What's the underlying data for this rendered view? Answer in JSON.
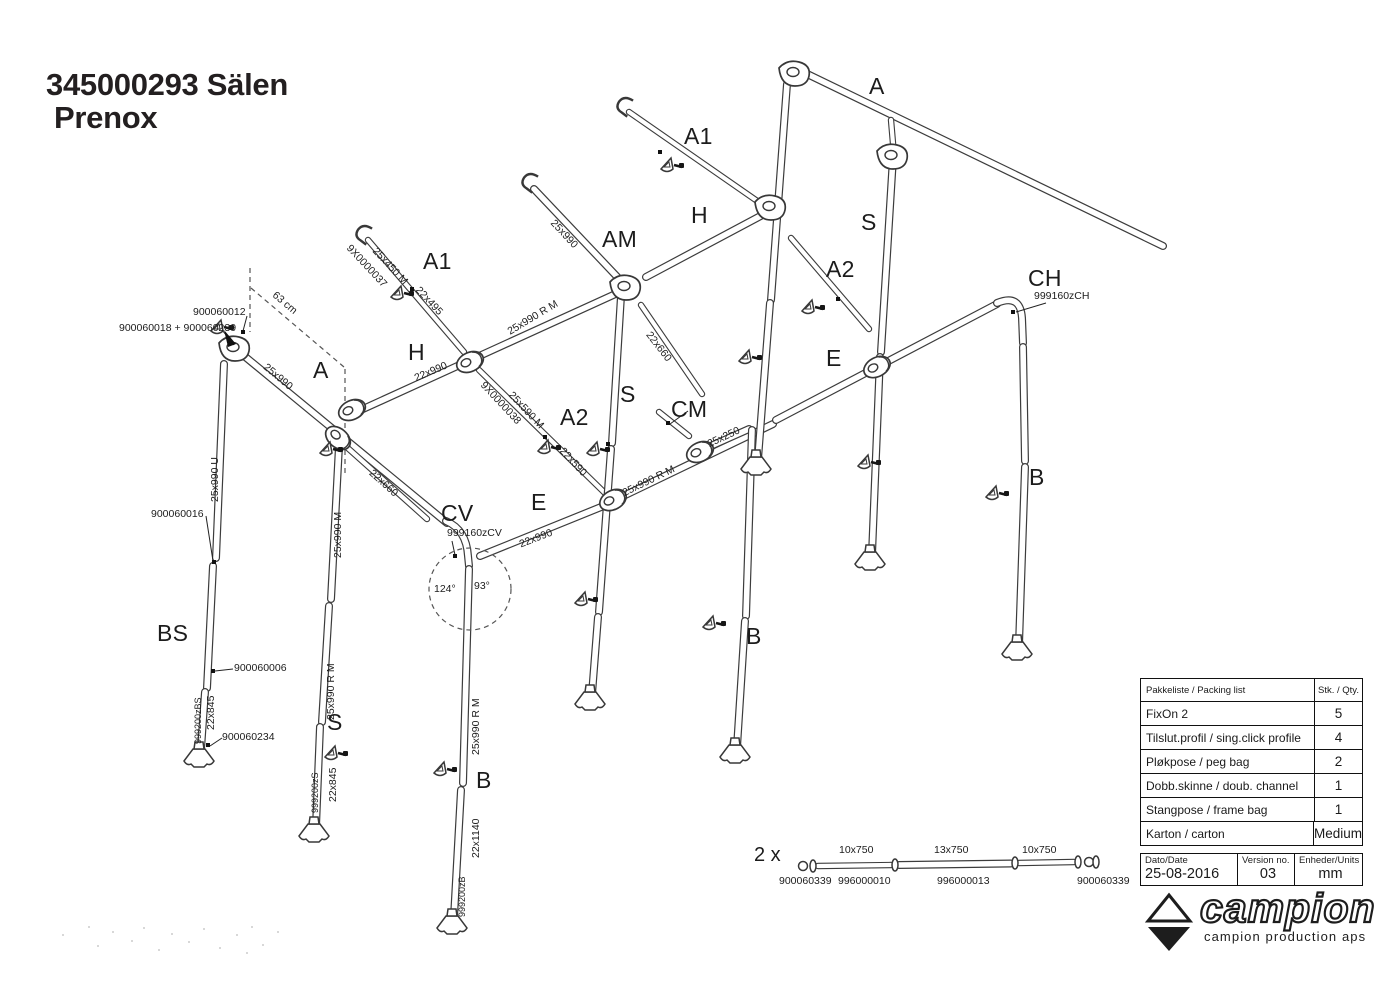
{
  "title": {
    "line1": "345000293 Sälen",
    "line2": "Prenox"
  },
  "diagram": {
    "labels": [
      {
        "t": "A",
        "x": 869,
        "y": 75,
        "s": "xl"
      },
      {
        "t": "A1",
        "x": 684,
        "y": 125,
        "s": "xl"
      },
      {
        "t": "H",
        "x": 691,
        "y": 204,
        "s": "xl"
      },
      {
        "t": "S",
        "x": 861,
        "y": 211,
        "s": "xl"
      },
      {
        "t": "A2",
        "x": 826,
        "y": 258,
        "s": "xl"
      },
      {
        "t": "AM",
        "x": 602,
        "y": 228,
        "s": "xl"
      },
      {
        "t": "CH",
        "x": 1028,
        "y": 267,
        "s": "xl"
      },
      {
        "t": "E",
        "x": 826,
        "y": 347,
        "s": "xl"
      },
      {
        "t": "CM",
        "x": 671,
        "y": 398,
        "s": "xl"
      },
      {
        "t": "S",
        "x": 620,
        "y": 383,
        "s": "xl"
      },
      {
        "t": "A2",
        "x": 560,
        "y": 406,
        "s": "xl"
      },
      {
        "t": "A1",
        "x": 423,
        "y": 250,
        "s": "xl"
      },
      {
        "t": "H",
        "x": 408,
        "y": 341,
        "s": "xl"
      },
      {
        "t": "A",
        "x": 313,
        "y": 359,
        "s": "xl"
      },
      {
        "t": "E",
        "x": 531,
        "y": 491,
        "s": "xl"
      },
      {
        "t": "CV",
        "x": 441,
        "y": 502,
        "s": "xl"
      },
      {
        "t": "B",
        "x": 1029,
        "y": 466,
        "s": "xl"
      },
      {
        "t": "B",
        "x": 746,
        "y": 625,
        "s": "xl"
      },
      {
        "t": "B",
        "x": 476,
        "y": 769,
        "s": "xl"
      },
      {
        "t": "S",
        "x": 327,
        "y": 711,
        "s": "xl"
      },
      {
        "t": "BS",
        "x": 157,
        "y": 622,
        "s": "xl"
      },
      {
        "t": "2 x",
        "x": 754,
        "y": 845,
        "s": "lg"
      },
      {
        "t": "900060012",
        "x": 193,
        "y": 307,
        "s": "sm"
      },
      {
        "t": "900060018 + 900060239",
        "x": 119,
        "y": 323,
        "s": "sm"
      },
      {
        "t": "900060016",
        "x": 151,
        "y": 509,
        "s": "sm"
      },
      {
        "t": "900060006",
        "x": 234,
        "y": 663,
        "s": "sm"
      },
      {
        "t": "900060234",
        "x": 222,
        "y": 732,
        "s": "sm"
      },
      {
        "t": "999160zCH",
        "x": 1034,
        "y": 291,
        "s": "sm"
      },
      {
        "t": "999160zCV",
        "x": 447,
        "y": 528,
        "s": "sm"
      },
      {
        "t": "124°",
        "x": 434,
        "y": 584,
        "s": "sm"
      },
      {
        "t": "93°",
        "x": 474,
        "y": 581,
        "s": "sm"
      },
      {
        "t": "10x750",
        "x": 839,
        "y": 845,
        "s": "sm"
      },
      {
        "t": "13x750",
        "x": 934,
        "y": 845,
        "s": "sm"
      },
      {
        "t": "10x750",
        "x": 1022,
        "y": 845,
        "s": "sm"
      },
      {
        "t": "900060339",
        "x": 779,
        "y": 876,
        "s": "sm"
      },
      {
        "t": "996000010",
        "x": 838,
        "y": 876,
        "s": "sm"
      },
      {
        "t": "996000013",
        "x": 937,
        "y": 876,
        "s": "sm"
      },
      {
        "t": "900060339",
        "x": 1077,
        "y": 876,
        "s": "sm"
      },
      {
        "t": "63 cm",
        "x": 277,
        "y": 290,
        "r": 40,
        "s": "sm"
      },
      {
        "t": "25x990",
        "x": 268,
        "y": 362,
        "r": 40,
        "s": "sm"
      },
      {
        "t": "22x660",
        "x": 374,
        "y": 468,
        "r": 42,
        "s": "sm"
      },
      {
        "t": "9X0000037",
        "x": 352,
        "y": 243,
        "r": 47,
        "s": "sm"
      },
      {
        "t": "25x450 M",
        "x": 378,
        "y": 246,
        "r": 47,
        "s": "sm"
      },
      {
        "t": "22x495",
        "x": 421,
        "y": 285,
        "r": 47,
        "s": "sm"
      },
      {
        "t": "9X0000038",
        "x": 486,
        "y": 380,
        "r": 47,
        "s": "sm"
      },
      {
        "t": "25x590 M",
        "x": 514,
        "y": 390,
        "r": 47,
        "s": "sm"
      },
      {
        "t": "22x590",
        "x": 565,
        "y": 446,
        "r": 47,
        "s": "sm"
      },
      {
        "t": "25x990",
        "x": 556,
        "y": 218,
        "r": 47,
        "s": "sm"
      },
      {
        "t": "22x660",
        "x": 652,
        "y": 330,
        "r": 52,
        "s": "sm"
      },
      {
        "t": "22x990",
        "x": 413,
        "y": 374,
        "r": -23,
        "s": "sm"
      },
      {
        "t": "25x990 R M",
        "x": 506,
        "y": 328,
        "r": -31,
        "s": "sm"
      },
      {
        "t": "25x250",
        "x": 706,
        "y": 440,
        "r": -25,
        "s": "sm"
      },
      {
        "t": "25x990 R M",
        "x": 621,
        "y": 489,
        "r": -26,
        "s": "sm"
      },
      {
        "t": "22x990",
        "x": 518,
        "y": 540,
        "r": -21,
        "s": "sm"
      },
      {
        "t": "25x990 U",
        "x": 210,
        "y": 502,
        "r": -90,
        "s": "sm"
      },
      {
        "t": "25x990 M",
        "x": 333,
        "y": 558,
        "r": -90,
        "s": "sm"
      },
      {
        "t": "25x990 R M",
        "x": 326,
        "y": 720,
        "r": -90,
        "s": "sm"
      },
      {
        "t": "22x845",
        "x": 206,
        "y": 730,
        "r": -90,
        "s": "sm"
      },
      {
        "t": "999200zBS",
        "x": 194,
        "y": 744,
        "r": -90,
        "s": "xs"
      },
      {
        "t": "22x845",
        "x": 328,
        "y": 802,
        "r": -90,
        "s": "sm"
      },
      {
        "t": "999200zS",
        "x": 311,
        "y": 813,
        "r": -90,
        "s": "xs"
      },
      {
        "t": "25x990 R M",
        "x": 471,
        "y": 755,
        "r": -90,
        "s": "sm"
      },
      {
        "t": "22x1140",
        "x": 471,
        "y": 858,
        "r": -90,
        "s": "sm"
      },
      {
        "t": "999200zB",
        "x": 458,
        "y": 917,
        "r": -90,
        "s": "xs"
      }
    ]
  },
  "packing_table": {
    "header": {
      "col1": "Pakkeliste / Packing list",
      "col2": "Stk. / Qty."
    },
    "rows": [
      {
        "item": "FixOn 2",
        "qty": "5"
      },
      {
        "item": "Tilslut.profil / sing.click profile",
        "qty": "4"
      },
      {
        "item": "Pløkpose / peg bag",
        "qty": "2"
      },
      {
        "item": "Dobb.skinne / doub. channel",
        "qty": "1"
      },
      {
        "item": "Stangpose / frame bag",
        "qty": "1"
      },
      {
        "item": "Karton / carton",
        "qty": "Medium"
      }
    ]
  },
  "info_table": {
    "date_label": "Dato/Date",
    "date_value": "25-08-2016",
    "version_label": "Version no.",
    "version_value": "03",
    "units_label": "Enheder/Units",
    "units_value": "mm"
  },
  "logo": {
    "brand": "campion",
    "tagline": "campion production aps"
  }
}
